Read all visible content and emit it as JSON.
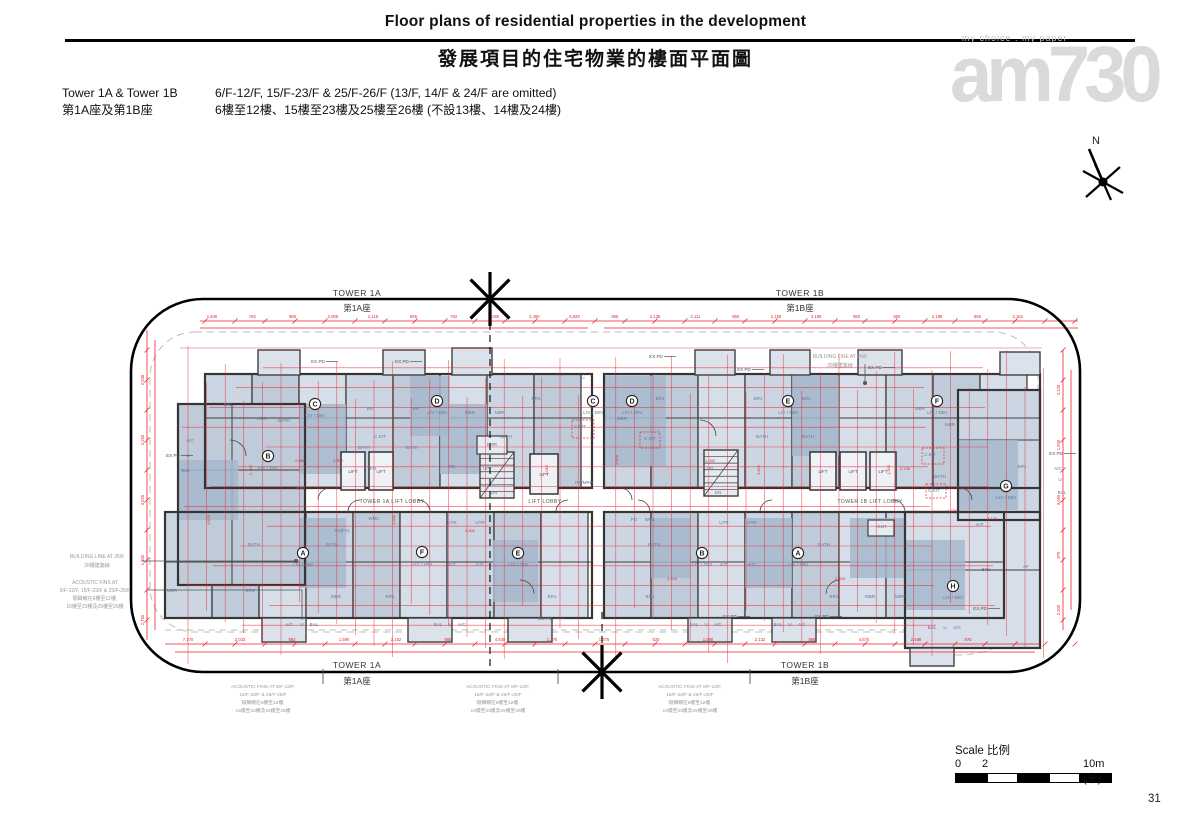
{
  "header": {
    "title_en": "Floor plans of residential properties in the development",
    "title_zh": "發展項目的住宅物業的樓面平面圖"
  },
  "info": {
    "tower_en": "Tower 1A & Tower 1B",
    "tower_zh": "第1A座及第1B座",
    "floors_en": "6/F-12/F, 15/F-23/F & 25/F-26/F (13/F, 14/F & 24/F are omitted)",
    "floors_zh": "6樓至12樓、15樓至23樓及25樓至26樓 (不設13樓、14樓及24樓)"
  },
  "watermark": {
    "tagline": "my choice . my paper",
    "logo": "am730"
  },
  "compass": {
    "label": "N"
  },
  "plan": {
    "tower_labels": [
      {
        "en": "TOWER 1A",
        "zh": "第1A座",
        "x": 357,
        "en_y": 296,
        "zh_y": 311
      },
      {
        "en": "TOWER 1B",
        "zh": "第1B座",
        "x": 800,
        "en_y": 296,
        "zh_y": 311
      },
      {
        "en": "TOWER 1A",
        "zh": "第1A座",
        "x": 357,
        "en_y": 668,
        "zh_y": 684
      },
      {
        "en": "TOWER 1B",
        "zh": "第1B座",
        "x": 805,
        "en_y": 668,
        "zh_y": 684
      }
    ],
    "liv_din": "LIV / DIN",
    "units": [
      {
        "l": "B",
        "x": 268,
        "y": 456
      },
      {
        "l": "C",
        "x": 315,
        "y": 404
      },
      {
        "l": "D",
        "x": 437,
        "y": 401
      },
      {
        "l": "C",
        "x": 593,
        "y": 401
      },
      {
        "l": "D",
        "x": 632,
        "y": 401
      },
      {
        "l": "E",
        "x": 788,
        "y": 401
      },
      {
        "l": "F",
        "x": 937,
        "y": 401
      },
      {
        "l": "G",
        "x": 1006,
        "y": 486
      },
      {
        "l": "A",
        "x": 303,
        "y": 553
      },
      {
        "l": "F",
        "x": 422,
        "y": 552
      },
      {
        "l": "E",
        "x": 518,
        "y": 553
      },
      {
        "l": "B",
        "x": 702,
        "y": 553
      },
      {
        "l": "A",
        "x": 798,
        "y": 553
      },
      {
        "l": "H",
        "x": 953,
        "y": 586
      }
    ],
    "rooms": [
      [
        "BR1",
        228,
        406
      ],
      [
        "BATH",
        284,
        422
      ],
      [
        "MBR",
        262,
        420
      ],
      [
        "A/C",
        190,
        442
      ],
      [
        "U",
        188,
        457
      ],
      [
        "BAL",
        186,
        472
      ],
      [
        "KIT",
        300,
        490
      ],
      [
        "C.KIT",
        380,
        438
      ],
      [
        "PD",
        373,
        470
      ],
      [
        "BR",
        370,
        410
      ],
      [
        "BR",
        416,
        410
      ],
      [
        "BATH",
        364,
        449
      ],
      [
        "BATH",
        412,
        449
      ],
      [
        "MBR",
        470,
        414
      ],
      [
        "MBR",
        500,
        414
      ],
      [
        "BR1",
        536,
        400
      ],
      [
        "BATH",
        506,
        438
      ],
      [
        "C.KIT",
        580,
        428
      ],
      [
        "EMR",
        492,
        446
      ],
      [
        "UP",
        486,
        470
      ],
      [
        "DN",
        494,
        494
      ],
      [
        "PD",
        452,
        468
      ],
      [
        "RS/MRR",
        584,
        484
      ],
      [
        "BR1",
        660,
        400
      ],
      [
        "MBR",
        622,
        420
      ],
      [
        "BR1",
        758,
        400
      ],
      [
        "BR1",
        806,
        400
      ],
      [
        "BATH",
        762,
        438
      ],
      [
        "BATH",
        808,
        438
      ],
      [
        "C.KIT",
        650,
        440
      ],
      [
        "UP",
        710,
        470
      ],
      [
        "DN",
        718,
        494
      ],
      [
        "MBR",
        920,
        410
      ],
      [
        "MBR",
        950,
        426
      ],
      [
        "BR1",
        1022,
        468
      ],
      [
        "C.KIT",
        930,
        456
      ],
      [
        "BATH",
        940,
        478
      ],
      [
        "C.KIT",
        934,
        492
      ],
      [
        "A/C",
        1058,
        470
      ],
      [
        "U",
        1060,
        481
      ],
      [
        "BAL",
        1062,
        494
      ],
      [
        "WMC",
        374,
        520
      ],
      [
        "PD(FS)",
        342,
        532
      ],
      [
        "UTR",
        452,
        524
      ],
      [
        "UTR",
        480,
        524
      ],
      [
        "KIT",
        452,
        566
      ],
      [
        "KIT",
        480,
        566
      ],
      [
        "BATH",
        332,
        546
      ],
      [
        "MBR",
        336,
        598
      ],
      [
        "BR1",
        390,
        598
      ],
      [
        "BAL",
        314,
        626
      ],
      [
        "U",
        302,
        626
      ],
      [
        "A/C",
        289,
        626
      ],
      [
        "BAL",
        438,
        626
      ],
      [
        "U",
        450,
        626
      ],
      [
        "A/C",
        462,
        626
      ],
      [
        "BR1",
        552,
        598
      ],
      [
        "MBR",
        172,
        592
      ],
      [
        "BR1",
        250,
        592
      ],
      [
        "BATH",
        254,
        546
      ],
      [
        "PD",
        634,
        521
      ],
      [
        "WML",
        650,
        521
      ],
      [
        "UTR",
        724,
        524
      ],
      [
        "UTR",
        752,
        524
      ],
      [
        "KIT",
        724,
        566
      ],
      [
        "KIT",
        752,
        566
      ],
      [
        "BATH",
        654,
        546
      ],
      [
        "BATH",
        824,
        546
      ],
      [
        "BR1",
        650,
        598
      ],
      [
        "BR1",
        834,
        598
      ],
      [
        "MBR",
        870,
        598
      ],
      [
        "MBR",
        900,
        598
      ],
      [
        "ELR",
        882,
        528
      ],
      [
        "BAL",
        694,
        626
      ],
      [
        "U",
        706,
        626
      ],
      [
        "A/C",
        718,
        626
      ],
      [
        "BAL",
        778,
        626
      ],
      [
        "U",
        790,
        626
      ],
      [
        "A/C",
        802,
        626
      ],
      [
        "KIT",
        980,
        526
      ],
      [
        "BR1",
        986,
        571
      ],
      [
        "AF",
        1026,
        568
      ],
      [
        "BAL",
        932,
        629
      ],
      [
        "U",
        945,
        629
      ],
      [
        "A/C",
        957,
        629
      ]
    ],
    "lift_label": "LIFT",
    "lifts": [
      [
        341,
        452,
        24,
        38
      ],
      [
        369,
        452,
        24,
        38
      ],
      [
        530,
        454,
        28,
        40
      ],
      [
        810,
        452,
        26,
        38
      ],
      [
        840,
        452,
        26,
        38
      ],
      [
        870,
        452,
        26,
        38
      ]
    ],
    "lobbies": [
      [
        "TOWER 1A LIFT LOBBY",
        392,
        503
      ],
      [
        "LIFT LOBBY",
        545,
        503
      ],
      [
        "TOWER 1B LIFT LOBBY",
        870,
        503
      ]
    ],
    "expd_label": "EX.PD",
    "expd": [
      [
        318,
        363
      ],
      [
        402,
        363
      ],
      [
        656,
        358
      ],
      [
        744,
        371
      ],
      [
        875,
        369
      ],
      [
        173,
        457
      ],
      [
        1056,
        455
      ],
      [
        545,
        620
      ],
      [
        730,
        618
      ],
      [
        822,
        618
      ],
      [
        980,
        610
      ]
    ],
    "annotations": {
      "building_line_left": [
        "BUILDING LINE AT 26/F",
        "26樓建築線"
      ],
      "acoustic_left": [
        "ACOUSTIC FINS AT",
        "6/F-12/F, 15/F-23/F & 25/F-26/F",
        "隔聲鰭在6樓至12樓,",
        "15樓至23樓及25樓至26樓"
      ],
      "building_line_right": [
        "BUILDING LINE AT 26/F",
        "26樓建築線"
      ],
      "acoustic_bottom": [
        "ACOUSTIC FINS AT 6/F-12/F,",
        "15/F-23/F & 25/F-26/F",
        "隔聲鰭在6樓至12樓,",
        "15樓至23樓及25樓至26樓"
      ],
      "acoustic_bottom_x": [
        263,
        498,
        690
      ]
    },
    "dims": {
      "top": [
        "1,940",
        "782",
        "865",
        "2,088",
        "2,118",
        "865",
        "782",
        "1,080",
        "2,460",
        "6,820",
        "865",
        "2,135",
        "2,111",
        "865",
        "2,150",
        "2,185",
        "950",
        "950",
        "2,188",
        "865",
        "2,162"
      ],
      "bottom": [
        "7,170",
        "2,033",
        "962",
        "1,590",
        "2,162",
        "865",
        "4,630",
        "1,275",
        "1,275",
        "620",
        "1,590",
        "2,132",
        "865",
        "4,570",
        "2,488",
        "875"
      ],
      "left": [
        "2,538",
        "4,250",
        "3,525",
        "1,300",
        "2,750"
      ],
      "right": [
        "2,125",
        "1,500",
        "3,050",
        "875",
        "2,300"
      ],
      "inner": [
        [
          "2,400",
          252,
          470,
          90
        ],
        [
          "4,800",
          338,
          462,
          0
        ],
        [
          "1,500",
          395,
          520,
          90
        ],
        [
          "2,600",
          470,
          532,
          0
        ],
        [
          "2,800",
          618,
          460,
          90
        ],
        [
          "2,400",
          672,
          580,
          0
        ],
        [
          "1,050",
          548,
          470,
          90
        ],
        [
          "2,135",
          905,
          470,
          0
        ],
        [
          "2,125",
          992,
          520,
          0
        ],
        [
          "4,730",
          952,
          512,
          0
        ],
        [
          "1,825",
          760,
          470,
          90
        ],
        [
          "2,400",
          840,
          580,
          0
        ],
        [
          "1,300",
          890,
          470,
          90
        ],
        [
          "1,825",
          210,
          520,
          90
        ],
        [
          "2,088",
          300,
          462,
          0
        ],
        [
          "1,080",
          710,
          462,
          0
        ]
      ]
    }
  },
  "scale": {
    "label": "Scale 比例",
    "t0": "0",
    "t2": "2",
    "t10": "10m (米)"
  },
  "page_number": "31"
}
